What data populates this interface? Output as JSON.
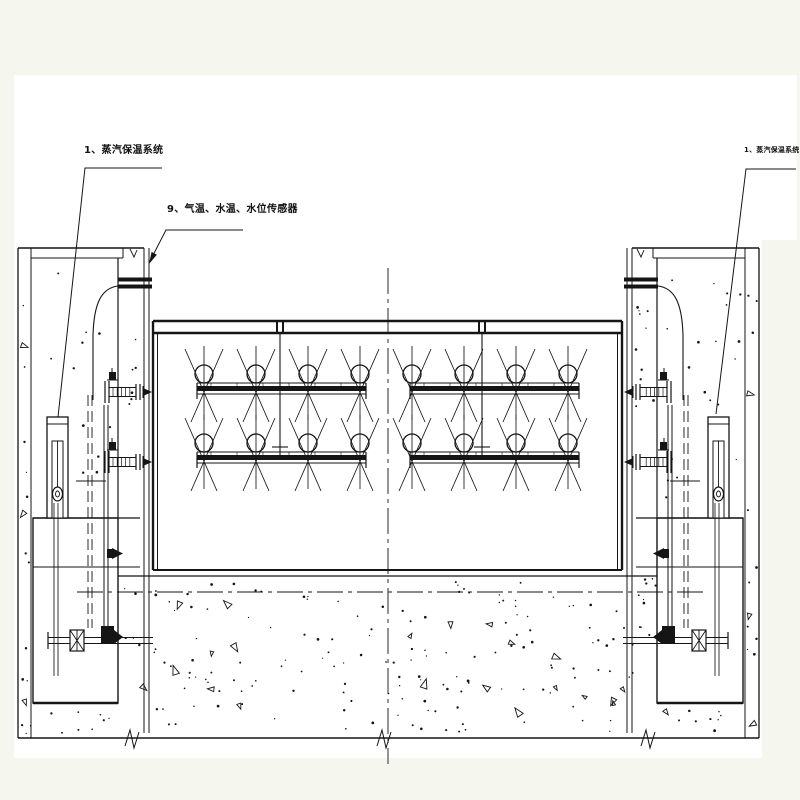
{
  "drawing": {
    "labels": {
      "steam_system_left": "1、蒸汽保温系统",
      "temp_water_level_sensors": "9、气温、水温、水位传感器",
      "steam_system_right": "1、蒸汽保温系统"
    },
    "colors": {
      "page_background": "#f5f6ee",
      "paper": "#ffffff",
      "line": "#151515"
    }
  }
}
